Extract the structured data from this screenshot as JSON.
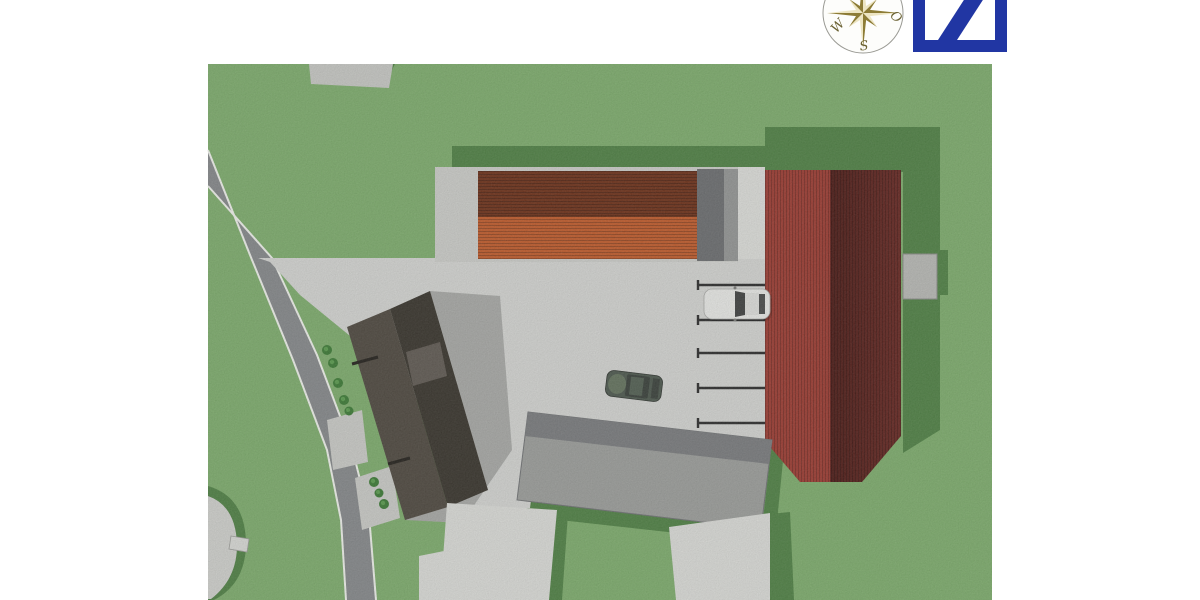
{
  "page": {
    "type": "3D architectural site plan rendering, top-down view",
    "background": "#ffffff"
  },
  "compass": {
    "labels": {
      "west": "W",
      "east": "O",
      "south": "S"
    },
    "star_dark": "#8d7c36",
    "star_light": "#ede5c2",
    "label_color": "#6b6233"
  },
  "branding": {
    "mark": "slash-in-square",
    "color": "#2136a3"
  },
  "site": {
    "ground": {
      "grass": "#7dac6c",
      "grass_shadow": "#4f8044",
      "road": "#85888a",
      "road_edge": "#eef0ea",
      "pavement": "#d3d4d1",
      "footpath": "#c9cac6",
      "white_plot": "#dadbd7"
    },
    "buildings": [
      {
        "id": "orange-roof-building",
        "roof_colors": [
          "#6e3119",
          "#c05b2b"
        ],
        "wall": "#cbccc8",
        "annex_dark": "#6b6d6f",
        "annex_light": "#939594",
        "path_strip": "#dcddd9"
      },
      {
        "id": "red-roof-building",
        "roof_colors": [
          "#9c3b31",
          "#5d221c"
        ],
        "annex": "#b7b8b4"
      },
      {
        "id": "dark-roof-building",
        "roof_colors": [
          "#4e483f",
          "#38342c"
        ],
        "skylight": "#5f5952",
        "shadow_on_pavement": "#a7a8a5"
      },
      {
        "id": "gray-flat-building",
        "roof_colors": [
          "#797b7d",
          "#9b9d9a"
        ]
      },
      {
        "id": "top-edge-cutoff-building",
        "roof_colors": [
          "#c6c7c3"
        ]
      },
      {
        "id": "curved-building-west",
        "roof_colors": [
          "#cfd0cc"
        ]
      }
    ],
    "parking": {
      "divider_line_count": 5,
      "marked_space_count": 4,
      "line_color": "#2c2c2c"
    },
    "cars": [
      {
        "id": "white-car",
        "color": "#e7e8e5",
        "glass": "#3f4140"
      },
      {
        "id": "dark-car",
        "color": "#4d584e",
        "glass": "#39403a"
      }
    ],
    "bush_count": 8,
    "bush_color": "#3c7a35"
  }
}
